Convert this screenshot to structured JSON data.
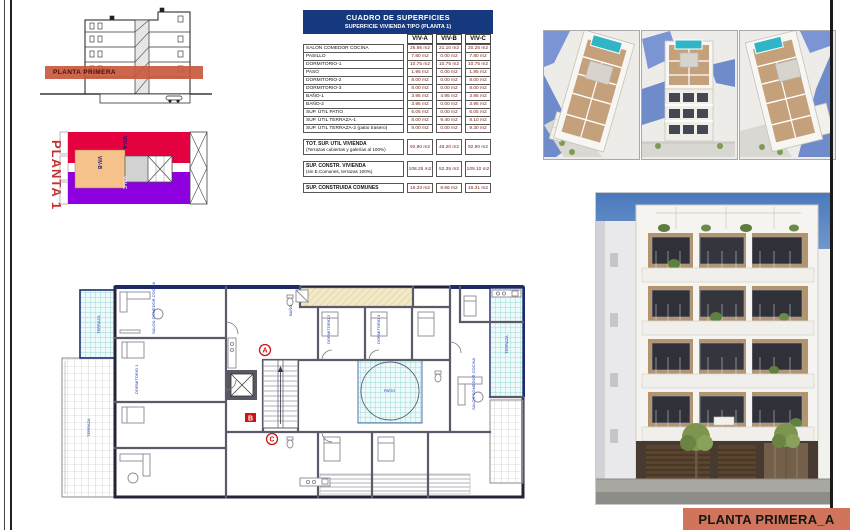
{
  "labels": {
    "section_band": "PLANTA PRIMERA",
    "key_plan_title": "PLANTA 1",
    "sheet_title": "PLANTA PRIMERA_A"
  },
  "key_plan": {
    "units": [
      {
        "id": "VIV-A",
        "color": "#e50040"
      },
      {
        "id": "VIV-B",
        "color": "#f6c28b"
      },
      {
        "id": "VIV-C",
        "color": "#8f00e0"
      }
    ]
  },
  "table": {
    "title": "CUADRO DE SUPERFICIES",
    "subtitle": "SUPERFICIE VIVIENDA TIPO (PLANTA 1)",
    "columns": [
      "VIV-A",
      "VIV-B",
      "VIV-C"
    ],
    "rows": [
      {
        "label": "SALON COMEDOR COCINA",
        "a": "25.95 m2",
        "b": "21.10 m2",
        "c": "20.25 m2"
      },
      {
        "label": "PASILLO",
        "a": "7.80 m2",
        "b": "0.00 m2",
        "c": "7.80 m2"
      },
      {
        "label": "DORMITORIO-1",
        "a": "10.75 m2",
        "b": "10.75 m2",
        "c": "10.75 m2"
      },
      {
        "label": "PASO",
        "a": "1.95 m2",
        "b": "0.00 m2",
        "c": "1.95 m2"
      },
      {
        "label": "DORMITORIO-2",
        "a": "8.00 m2",
        "b": "0.00 m2",
        "c": "8.00 m2"
      },
      {
        "label": "DORMITORIO-3",
        "a": "8.00 m2",
        "b": "0.00 m2",
        "c": "8.00 m2"
      },
      {
        "label": "BAÑO-1",
        "a": "3.95 m2",
        "b": "4.95 m2",
        "c": "3.95 m2"
      },
      {
        "label": "BAÑO-2",
        "a": "3.95 m2",
        "b": "0.00 m2",
        "c": "3.95 m2"
      },
      {
        "label": "SUP. ÚTIL PATIO",
        "a": "6.05 m2",
        "b": "0.00 m2",
        "c": "6.05 m2"
      },
      {
        "label": "SUP. ÚTIL TERRAZA-1",
        "a": "8.00 m2",
        "b": "9.40 m2",
        "c": "8.10 m2"
      },
      {
        "label": "SUP. ÚTIL TERRAZA-2 (patio trasero)",
        "a": "9.00 m2",
        "b": "0.00 m2",
        "c": "9.30 m2"
      }
    ],
    "summary": [
      {
        "label1": "TOT. SUP. ÚTIL VIVIENDA",
        "label2": "(Terrazas cubiertas y galerías al 100%)",
        "a": "92.80 m2",
        "b": "46.20 m2",
        "c": "92.90 m2"
      },
      {
        "label1": "SUP. CONSTR. VIVIENDA",
        "label2": "(sin E.Comunes, terrazas 100%)",
        "a": "108.25 m2",
        "b": "52.35 m2",
        "c": "109.10 m2"
      },
      {
        "label1": "SUP. CONSTRUIDA COMUNES",
        "label2": "",
        "a": "16.33 m2",
        "b": "8.66 m2",
        "c": "16.31 m2"
      }
    ]
  },
  "floor_plan": {
    "unit_markers": [
      "A",
      "B",
      "C"
    ],
    "labels": [
      "TERRAZA",
      "TERRAZA",
      "SALON COMEDOR COCINA",
      "DORMITORIO 1",
      "DORMITORIO 2",
      "DORMITORIO 3",
      "SALON COMEDOR COCINA",
      "PATIO",
      "TERRAZA",
      "BAÑO"
    ]
  },
  "colors": {
    "header_navy": "#16387e",
    "band_salmon": "#d0755b",
    "value_red": "#7a2418",
    "unit_a_red": "#e50040",
    "unit_b_orange": "#f6c28b",
    "unit_c_purple": "#8f00e0",
    "pool_teal": "#2fb5c6"
  }
}
